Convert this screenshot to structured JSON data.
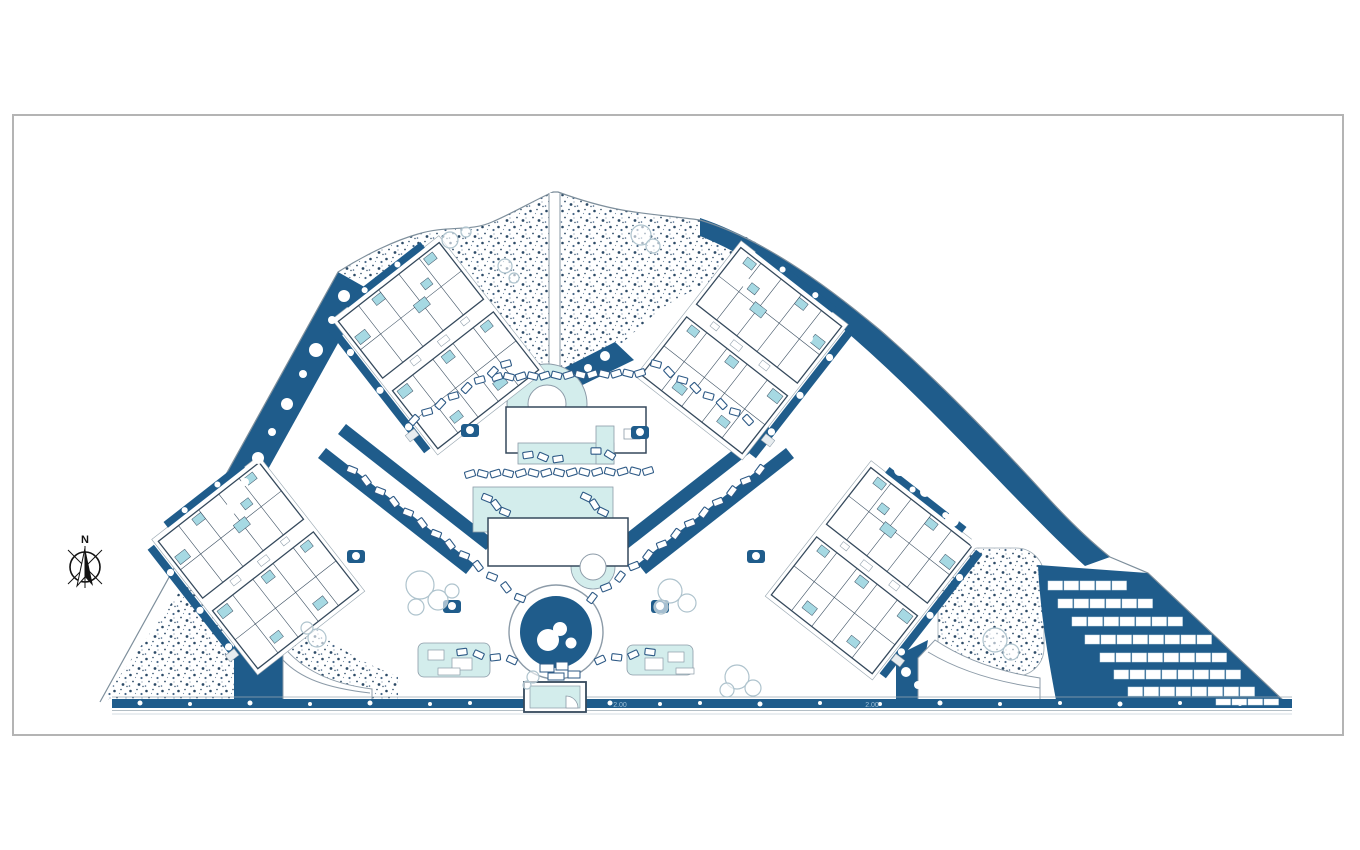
{
  "meta": {
    "drawing_type": "residential master site plan",
    "sheet": {
      "frame_x": 13,
      "frame_y": 115,
      "frame_w": 1330,
      "frame_h": 620
    }
  },
  "labels": {
    "north": "N",
    "dim_left": "2.00",
    "dim_right": "2.00"
  },
  "colors": {
    "deep_blue": "#1F5C8B",
    "pale_cyan": "#D3EDEC",
    "unit_cyan": "#A6D9E3",
    "outline_dark": "#35495C",
    "outline_gray": "#8C9BA8",
    "terrace_gray": "#9AA8B2",
    "frame_gray": "#B4B4B4",
    "tree_outline": "#AEC3CD",
    "bed_blue": "#2E5A86",
    "dim_text": "#9FC0D8",
    "white": "#FFFFFF"
  },
  "compass": {
    "x": 85,
    "y": 567,
    "r": 15
  },
  "clusters": [
    {
      "name": "block-top-left",
      "cx": 438,
      "cy": 345,
      "rot": -38,
      "sx": 1
    },
    {
      "name": "block-left",
      "cx": 258,
      "cy": 565,
      "rot": -38,
      "sx": 1
    },
    {
      "name": "block-top-right",
      "cx": 742,
      "cy": 350,
      "rot": 38,
      "sx": -1
    },
    {
      "name": "block-right",
      "cx": 872,
      "cy": 570,
      "rot": 38,
      "sx": -1
    }
  ],
  "solar": {
    "panel_w": 14.5,
    "pitch": 16,
    "rows": [
      {
        "x": 1048,
        "y": 581,
        "count": 5,
        "h": 9
      },
      {
        "x": 1058,
        "y": 599,
        "count": 6,
        "h": 9
      },
      {
        "x": 1072,
        "y": 617,
        "count": 7,
        "h": 9
      },
      {
        "x": 1085,
        "y": 635,
        "count": 8,
        "h": 9
      },
      {
        "x": 1100,
        "y": 653,
        "count": 8,
        "h": 9
      },
      {
        "x": 1114,
        "y": 670,
        "count": 8,
        "h": 9
      },
      {
        "x": 1128,
        "y": 687,
        "count": 8,
        "h": 9
      },
      {
        "x": 1216,
        "y": 699,
        "count": 4,
        "h": 6
      }
    ]
  },
  "sunbed_chains": [
    [
      497,
      377,
      640,
      373,
      13
    ],
    [
      470,
      474,
      648,
      471,
      15
    ],
    [
      414,
      420,
      506,
      364,
      8
    ],
    [
      656,
      364,
      748,
      420,
      8
    ],
    [
      352,
      470,
      520,
      598,
      13
    ],
    [
      592,
      598,
      760,
      470,
      13
    ],
    [
      462,
      652,
      512,
      660,
      4
    ],
    [
      600,
      660,
      650,
      652,
      4
    ],
    [
      528,
      455,
      558,
      459,
      3
    ],
    [
      596,
      451,
      610,
      455,
      2
    ],
    [
      487,
      498,
      505,
      512,
      3
    ],
    [
      586,
      497,
      603,
      512,
      3
    ]
  ],
  "trees": [
    [
      420,
      585,
      14
    ],
    [
      438,
      600,
      10
    ],
    [
      416,
      607,
      8
    ],
    [
      452,
      591,
      7
    ],
    [
      670,
      591,
      12
    ],
    [
      687,
      603,
      9
    ],
    [
      661,
      607,
      7
    ],
    [
      737,
      677,
      12
    ],
    [
      753,
      688,
      8
    ],
    [
      727,
      690,
      7
    ],
    [
      317,
      638,
      9
    ],
    [
      307,
      628,
      6
    ],
    [
      533,
      677,
      6
    ],
    [
      527,
      685,
      4
    ],
    [
      995,
      640,
      12
    ],
    [
      1011,
      652,
      8
    ],
    [
      641,
      235,
      10
    ],
    [
      653,
      246,
      7
    ],
    [
      505,
      266,
      7
    ],
    [
      514,
      278,
      5
    ],
    [
      450,
      240,
      8
    ],
    [
      466,
      232,
      5
    ]
  ],
  "bushes": [
    [
      344,
      296,
      6
    ],
    [
      332,
      320,
      4
    ],
    [
      316,
      350,
      7
    ],
    [
      303,
      374,
      4
    ],
    [
      287,
      404,
      6
    ],
    [
      272,
      432,
      4
    ],
    [
      258,
      458,
      6
    ],
    [
      245,
      482,
      4
    ],
    [
      232,
      508,
      6
    ],
    [
      745,
      282,
      5
    ],
    [
      777,
      310,
      7
    ],
    [
      808,
      338,
      5
    ],
    [
      840,
      372,
      7
    ],
    [
      862,
      434,
      13
    ],
    [
      879,
      449,
      8
    ],
    [
      900,
      470,
      6
    ],
    [
      925,
      492,
      5
    ],
    [
      952,
      520,
      7
    ],
    [
      975,
      543,
      5
    ],
    [
      512,
      356,
      5
    ],
    [
      530,
      368,
      4
    ],
    [
      588,
      368,
      4
    ],
    [
      605,
      356,
      5
    ],
    [
      350,
      452,
      5
    ],
    [
      380,
      476,
      4
    ],
    [
      412,
      502,
      5
    ],
    [
      444,
      528,
      4
    ],
    [
      700,
      452,
      5
    ],
    [
      672,
      476,
      4
    ],
    [
      640,
      502,
      5
    ],
    [
      612,
      528,
      4
    ],
    [
      250,
      640,
      5
    ],
    [
      262,
      655,
      4
    ],
    [
      906,
      672,
      5
    ],
    [
      918,
      685,
      4
    ]
  ],
  "garden_patches": [
    [
      470,
      430
    ],
    [
      640,
      432
    ],
    [
      356,
      556
    ],
    [
      756,
      556
    ],
    [
      452,
      606
    ],
    [
      660,
      606
    ]
  ],
  "road_dots": [
    [
      140,
      703,
      2.5
    ],
    [
      190,
      704,
      2
    ],
    [
      250,
      703,
      2.5
    ],
    [
      310,
      704,
      2
    ],
    [
      370,
      703,
      2.5
    ],
    [
      430,
      704,
      2
    ],
    [
      470,
      703,
      2
    ],
    [
      610,
      703,
      2.5
    ],
    [
      660,
      704,
      2
    ],
    [
      700,
      703,
      2
    ],
    [
      760,
      704,
      2.5
    ],
    [
      820,
      703,
      2
    ],
    [
      880,
      704,
      2
    ],
    [
      940,
      703,
      2.5
    ],
    [
      1000,
      704,
      2
    ],
    [
      1060,
      703,
      2
    ],
    [
      1120,
      704,
      2.5
    ],
    [
      1180,
      703,
      2
    ],
    [
      1240,
      704,
      2
    ]
  ],
  "pool_area": {
    "club_donut": {
      "cx": 547,
      "cy": 404,
      "r_out": 40,
      "r_in": 19
    },
    "club_building": [
      506,
      407,
      140,
      46
    ],
    "club_deck": [
      518,
      443,
      96,
      21
    ],
    "club_side": [
      596,
      426,
      18,
      38
    ],
    "main_deck": [
      473,
      487,
      140,
      45
    ],
    "main_pool": [
      488,
      518,
      140,
      48
    ],
    "spa_donut": {
      "cx": 593,
      "cy": 567,
      "r_out": 22,
      "r_in": 13
    },
    "feature_circle": {
      "cx": 556,
      "cy": 632,
      "r_out": 47,
      "r_in": 36,
      "blobs": [
        [
          548,
          640,
          11
        ],
        [
          560,
          629,
          7
        ],
        [
          571,
          643,
          5.5
        ]
      ]
    },
    "deck_left": [
      418,
      643,
      72,
      34
    ],
    "deck_right": [
      627,
      645,
      66,
      30
    ],
    "entrance": [
      524,
      682,
      62,
      30
    ]
  }
}
